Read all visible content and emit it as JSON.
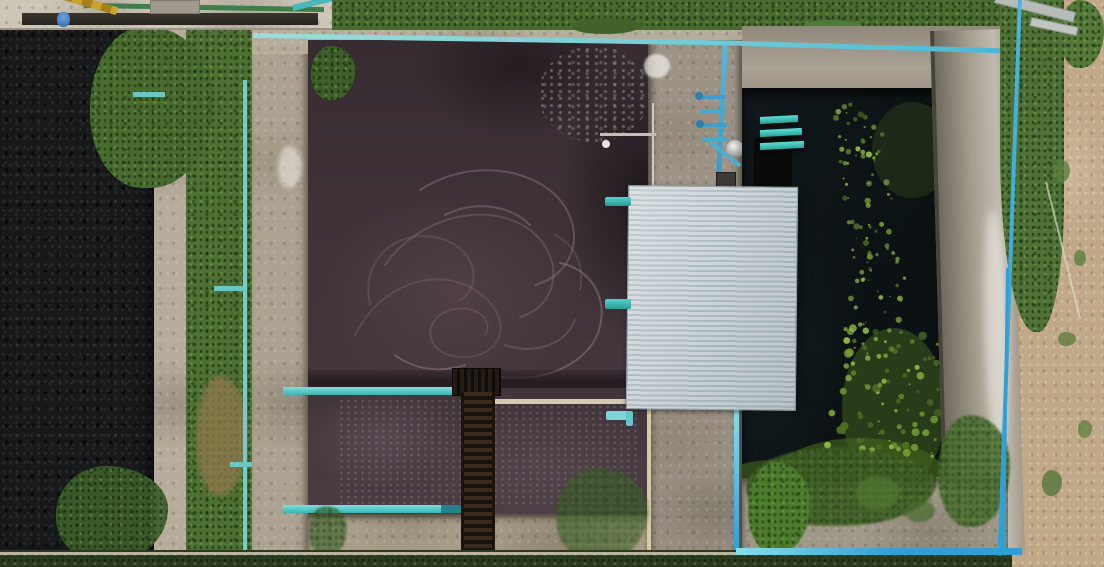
{
  "scene": {
    "type": "aerial-photograph",
    "subject": "wastewater-treatment-plant",
    "view": "top-down-drone",
    "width_px": 1104,
    "height_px": 567,
    "objects": [
      "sludge-pond",
      "aeration-basin",
      "clarifier-basin",
      "corrugated-metal-roof",
      "blue-pvc-pipe-network",
      "teal-outlet-pipes",
      "metal-catwalk",
      "concrete-walls",
      "grass-strips",
      "algae-bloom",
      "maintenance-machinery",
      "silver-tank",
      "control-box"
    ]
  },
  "palette": {
    "concrete": "#b2a998",
    "concrete_light": "#cac3b4",
    "concrete_dark": "#8e8678",
    "pond": "#17191b",
    "basin_upper": "#3c3136",
    "basin_lower": "#463a41",
    "seam_dark": "#241c20",
    "water": "#0e1416",
    "algae": "#7da43a",
    "algae_light": "#95bd48",
    "algae_mat": "#4e7022",
    "grass": "#4c7133",
    "grass_dark": "#2c3a20",
    "sand": "#c0a888",
    "roof_light": "#cdd6da",
    "roof_dark": "#aeb9c0",
    "pipe_teal": "#5fcfcf",
    "pipe_teal_dark": "#2e8f9e",
    "pipe_cyan": "#45b7d8",
    "pipe_blue": "#2f9fd4",
    "pipe_blue_light": "#8adfe4",
    "pipe_tan": "#d9c9a0",
    "pipe_white": "#d3cab6",
    "pipe_green": "#3f7d4a",
    "machine_yellow": "#c9a32b",
    "worker_blue": "#2d6cb5",
    "catwalk_rust": "#3a2a1e",
    "catwalk_dark": "#17110d",
    "swirl": "#8a7280",
    "foam": "#efece8"
  },
  "swirls": {
    "stroke_width": 2,
    "paths": [
      "M30,190 C55,140 110,120 150,145 C195,175 175,215 135,212 C100,210 95,175 125,165 C150,158 170,175 160,190",
      "M60,120 C95,70 165,55 205,85 C240,112 235,160 195,172",
      "M95,45 C140,15 205,20 235,55 C262,88 248,130 210,140",
      "M150,225 C190,242 245,232 268,198 C288,165 272,125 235,118",
      "M45,160 C35,115 70,85 110,92 C150,100 160,140 135,155",
      "M180,200 C210,210 240,200 250,175",
      "M120,70 C150,55 185,60 205,80",
      "M70,210 C90,225 115,228 140,220",
      "M230,90 C250,100 260,120 255,145"
    ]
  },
  "algae": {
    "seed": 11,
    "scatter_count": 130,
    "mat_dots": 70,
    "mats": [
      {
        "cx": 152,
        "cy": 320,
        "rx": 52,
        "ry": 80,
        "fill": "#46661f",
        "o": 0.5
      },
      {
        "cx": 118,
        "cy": 392,
        "rx": 88,
        "ry": 42,
        "fill": "#42601e",
        "o": 0.7
      },
      {
        "cx": 30,
        "cy": 406,
        "rx": 62,
        "ry": 34,
        "fill": "#3a571c",
        "o": 0.75
      },
      {
        "cx": 170,
        "cy": 62,
        "rx": 40,
        "ry": 48,
        "fill": "#3f5e1e",
        "o": 0.3
      }
    ]
  }
}
